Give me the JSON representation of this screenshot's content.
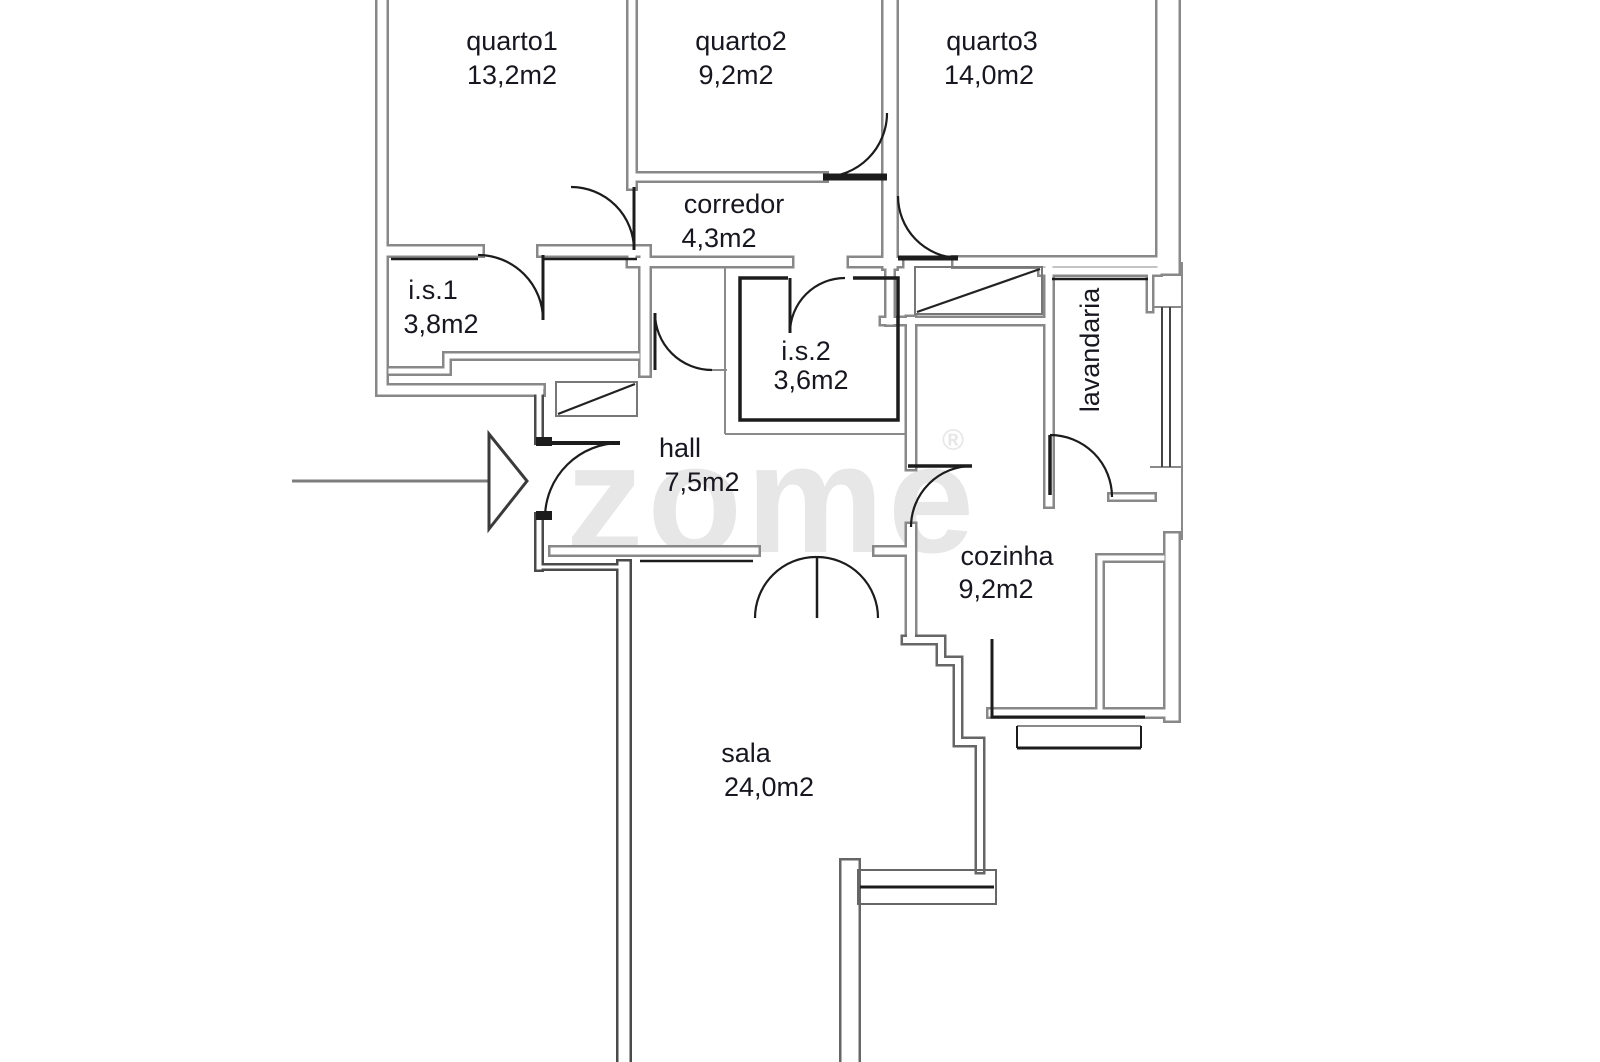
{
  "plan_title": "floor-plan",
  "watermark": {
    "text": "zome",
    "reg": "®",
    "color": "#e7e7e7"
  },
  "colors": {
    "background": "#ffffff",
    "wall_gray": "#888888",
    "wall_dark": "#4a4a4a",
    "wall_mid": "#666666",
    "thin_gray": "#8a8a8a",
    "black": "#1c1c1c",
    "label": "#17171f",
    "arrow": "#7d7d7d",
    "arrow_head": "#3a3a3a",
    "glazing": "#444444",
    "window_frame": "#666666"
  },
  "rooms": [
    {
      "id": "quarto1",
      "name": "quarto1",
      "area": "13,2m2",
      "nx": 512,
      "ny": 50,
      "ax": 512,
      "ay": 84,
      "vertical": false
    },
    {
      "id": "quarto2",
      "name": "quarto2",
      "area": "9,2m2",
      "nx": 741,
      "ny": 50,
      "ax": 736,
      "ay": 84,
      "vertical": false
    },
    {
      "id": "quarto3",
      "name": "quarto3",
      "area": "14,0m2",
      "nx": 992,
      "ny": 50,
      "ax": 989,
      "ay": 84,
      "vertical": false
    },
    {
      "id": "corredor",
      "name": "corredor",
      "area": "4,3m2",
      "nx": 734,
      "ny": 213,
      "ax": 719,
      "ay": 247,
      "vertical": false
    },
    {
      "id": "is1",
      "name": "i.s.1",
      "area": "3,8m2",
      "nx": 433,
      "ny": 299,
      "ax": 441,
      "ay": 333,
      "vertical": false
    },
    {
      "id": "is2",
      "name": "i.s.2",
      "area": "3,6m2",
      "nx": 806,
      "ny": 360,
      "ax": 811,
      "ay": 389,
      "vertical": false
    },
    {
      "id": "lavandaria",
      "name": "lavandaria",
      "area": "",
      "nx": 1099,
      "ny": 350,
      "ax": 0,
      "ay": 0,
      "vertical": true
    },
    {
      "id": "hall",
      "name": "hall",
      "area": "7,5m2",
      "nx": 680,
      "ny": 457,
      "ax": 702,
      "ay": 491,
      "vertical": false
    },
    {
      "id": "cozinha",
      "name": "cozinha",
      "area": "9,2m2",
      "nx": 1007,
      "ny": 565,
      "ax": 996,
      "ay": 598,
      "vertical": false
    },
    {
      "id": "sala",
      "name": "sala",
      "area": "24,0m2",
      "nx": 746,
      "ny": 762,
      "ax": 769,
      "ay": 796,
      "vertical": false
    }
  ],
  "entrance_arrow": {
    "line": [
      292,
      481,
      489,
      481
    ],
    "head": [
      [
        489,
        434
      ],
      [
        489,
        529
      ],
      [
        527,
        481
      ]
    ]
  },
  "geometry": {
    "walls": [
      {
        "p": [
          [
            382,
            0
          ],
          [
            382,
            390
          ],
          [
            539,
            390
          ]
        ],
        "w": 14,
        "c": "wall_gray"
      },
      {
        "p": [
          [
            539,
            394
          ],
          [
            539,
            440
          ]
        ],
        "w": 10,
        "c": "wall_dark"
      },
      {
        "p": [
          [
            539,
            517
          ],
          [
            539,
            567
          ]
        ],
        "w": 10,
        "c": "wall_dark"
      },
      {
        "p": [
          [
            539,
            567
          ],
          [
            624,
            567
          ]
        ],
        "w": 8,
        "c": "wall_dark"
      },
      {
        "p": [
          [
            624,
            567
          ],
          [
            624,
            1062
          ]
        ],
        "w": 16,
        "c": "wall_dark"
      },
      {
        "p": [
          [
            632,
            0
          ],
          [
            632,
            185
          ]
        ],
        "w": 12,
        "c": "wall_gray"
      },
      {
        "p": [
          [
            632,
            250
          ],
          [
            632,
            262
          ]
        ],
        "w": 12,
        "c": "wall_gray"
      },
      {
        "p": [
          [
            382,
            251
          ],
          [
            478,
            251
          ]
        ],
        "w": 14,
        "c": "wall_gray"
      },
      {
        "p": [
          [
            543,
            251
          ],
          [
            637,
            251
          ]
        ],
        "w": 14,
        "c": "wall_gray"
      },
      {
        "p": [
          [
            645,
            251
          ],
          [
            645,
            371
          ]
        ],
        "w": 14,
        "c": "wall_gray"
      },
      {
        "p": [
          [
            391,
            371
          ],
          [
            447,
            371
          ],
          [
            447,
            356
          ],
          [
            637,
            356
          ]
        ],
        "w": 10,
        "c": "wall_gray"
      },
      {
        "p": [
          [
            632,
            177
          ],
          [
            823,
            177
          ]
        ],
        "w": 12,
        "c": "wall_gray"
      },
      {
        "p": [
          [
            890,
            0
          ],
          [
            890,
            262
          ]
        ],
        "w": 18,
        "c": "wall_gray"
      },
      {
        "p": [
          [
            632,
            262
          ],
          [
            788,
            262
          ]
        ],
        "w": 13,
        "c": "wall_gray"
      },
      {
        "p": [
          [
            853,
            262
          ],
          [
            898,
            262
          ]
        ],
        "w": 13,
        "c": "wall_gray"
      },
      {
        "p": [
          [
            958,
            262
          ],
          [
            1162,
            262
          ]
        ],
        "w": 14,
        "c": "wall_gray"
      },
      {
        "p": [
          [
            1168,
            0
          ],
          [
            1168,
            263
          ]
        ],
        "w": 26,
        "c": "wall_gray"
      },
      {
        "p": [
          [
            890,
            262
          ],
          [
            890,
            321
          ]
        ],
        "w": 12,
        "c": "wall_gray"
      },
      {
        "p": [
          [
            884,
            321
          ],
          [
            1049,
            321
          ]
        ],
        "w": 11,
        "c": "wall_gray"
      },
      {
        "p": [
          [
            911,
            321
          ],
          [
            911,
            465
          ]
        ],
        "w": 13,
        "c": "wall_gray"
      },
      {
        "p": [
          [
            911,
            528
          ],
          [
            911,
            637
          ]
        ],
        "w": 13,
        "c": "wall_gray"
      },
      {
        "p": [
          [
            554,
            551
          ],
          [
            755,
            551
          ]
        ],
        "w": 12,
        "c": "wall_gray"
      },
      {
        "p": [
          [
            878,
            551
          ],
          [
            911,
            551
          ]
        ],
        "w": 12,
        "c": "wall_gray"
      },
      {
        "p": [
          [
            906,
            640
          ],
          [
            941,
            640
          ],
          [
            941,
            661
          ],
          [
            958,
            661
          ],
          [
            958,
            742
          ],
          [
            980,
            742
          ],
          [
            980,
            869
          ]
        ],
        "w": 11,
        "c": "wall_mid"
      },
      {
        "p": [
          [
            850,
            869
          ],
          [
            850,
            1062
          ]
        ],
        "w": 22,
        "c": "wall_mid"
      },
      {
        "p": [
          [
            1049,
            265
          ],
          [
            1049,
            503
          ]
        ],
        "w": 12,
        "c": "wall_gray"
      },
      {
        "p": [
          [
            1043,
            271
          ],
          [
            1157,
            271
          ]
        ],
        "w": 12,
        "c": "wall_gray"
      },
      {
        "p": [
          [
            1150,
            275
          ],
          [
            1150,
            309
          ]
        ],
        "w": 9,
        "c": "wall_gray"
      },
      {
        "p": [
          [
            1112,
            497
          ],
          [
            1152,
            497
          ]
        ],
        "w": 10,
        "c": "wall_gray"
      },
      {
        "p": [
          [
            1172,
            540
          ],
          [
            1172,
            714
          ]
        ],
        "w": 18,
        "c": "wall_gray"
      },
      {
        "p": [
          [
            1100,
            558
          ],
          [
            1162,
            558
          ]
        ],
        "w": 10,
        "c": "wall_gray"
      },
      {
        "p": [
          [
            1100,
            558
          ],
          [
            1100,
            714
          ]
        ],
        "w": 10,
        "c": "wall_gray"
      },
      {
        "p": [
          [
            992,
            713
          ],
          [
            1172,
            713
          ]
        ],
        "w": 12,
        "c": "wall_gray"
      }
    ],
    "thin_lines": [
      {
        "p": [
          [
            1182,
            262
          ],
          [
            1182,
            540
          ]
        ],
        "w": 2,
        "c": "thin_gray"
      },
      {
        "p": [
          [
            725,
            262
          ],
          [
            725,
            434
          ]
        ],
        "w": 2,
        "c": "thin_gray"
      },
      {
        "p": [
          [
            725,
            434
          ],
          [
            908,
            434
          ]
        ],
        "w": 2,
        "c": "thin_gray"
      },
      {
        "p": [
          [
            712,
            370
          ],
          [
            727,
            370
          ]
        ],
        "w": 2,
        "c": "thin_gray"
      },
      {
        "p": [
          [
            1150,
            307
          ],
          [
            1182,
            307
          ]
        ],
        "w": 2,
        "c": "thin_gray"
      },
      {
        "p": [
          [
            1150,
            467
          ],
          [
            1182,
            467
          ]
        ],
        "w": 2,
        "c": "thin_gray"
      },
      {
        "p": [
          [
            1017,
            726
          ],
          [
            1141,
            726
          ]
        ],
        "w": 2,
        "c": "thin_gray"
      }
    ],
    "black_lines": [
      {
        "p": [
          [
            391,
            259
          ],
          [
            478,
            259
          ]
        ],
        "w": 2.5
      },
      {
        "p": [
          [
            543,
            259
          ],
          [
            637,
            259
          ]
        ],
        "w": 2.5
      },
      {
        "p": [
          [
            640,
            561
          ],
          [
            753,
            561
          ]
        ],
        "w": 2.5
      },
      {
        "p": [
          [
            1052,
            279
          ],
          [
            1148,
            279
          ]
        ],
        "w": 2.5
      },
      {
        "p": [
          [
            992,
            639
          ],
          [
            992,
            717
          ],
          [
            1145,
            717
          ]
        ],
        "w": 3
      },
      {
        "p": [
          [
            1017,
            748
          ],
          [
            1141,
            748
          ]
        ],
        "w": 3
      },
      {
        "p": [
          [
            1017,
            726
          ],
          [
            1017,
            748
          ]
        ],
        "w": 2
      },
      {
        "p": [
          [
            1141,
            726
          ],
          [
            1141,
            748
          ]
        ],
        "w": 2
      },
      {
        "p": [
          [
            860,
            887
          ],
          [
            994,
            887
          ]
        ],
        "w": 3
      }
    ],
    "black_rects": [
      {
        "x": 536,
        "y": 437,
        "w": 16,
        "h": 9
      },
      {
        "x": 536,
        "y": 511,
        "w": 16,
        "h": 9
      }
    ],
    "is2_inner_box": "M 853,278 L 898,278 L 898,420 L 740,420 L 740,278 L 788,278",
    "doors": [
      {
        "id": "door-quarto1",
        "leaf": [
          [
            634,
            187
          ],
          [
            634,
            250
          ]
        ],
        "lw": 3,
        "arc": "M 571,187 A 63,63 0 0 1 634,250"
      },
      {
        "id": "door-quarto2",
        "leaf": [
          [
            823,
            177
          ],
          [
            887,
            177
          ]
        ],
        "lw": 7,
        "arc": "M 823,177 A 64,64 0 0 0 887,113"
      },
      {
        "id": "door-quarto3",
        "leaf": [
          [
            898,
            258
          ],
          [
            958,
            258
          ]
        ],
        "lw": 5,
        "arc": "M 898,196 A 62,62 0 0 0 958,258"
      },
      {
        "id": "door-is1",
        "leaf": [
          [
            543,
            255
          ],
          [
            543,
            320
          ]
        ],
        "lw": 3,
        "arc": "M 478,255 A 65,65 0 0 1 543,320"
      },
      {
        "id": "door-is2",
        "leaf": [
          [
            790,
            278
          ],
          [
            790,
            333
          ]
        ],
        "lw": 3,
        "arc": "M 790,333 A 55,55 0 0 1 845,278"
      },
      {
        "id": "door-corredor",
        "leaf": [
          [
            655,
            313
          ],
          [
            655,
            370
          ]
        ],
        "lw": 3,
        "arc": "M 655,313 A 57,57 0 0 0 712,370"
      },
      {
        "id": "door-entrada",
        "leaf": [
          [
            545,
            443
          ],
          [
            620,
            443
          ]
        ],
        "lw": 4,
        "arc": "M 620,443 A 75,75 0 0 0 545,517"
      },
      {
        "id": "door-cozinha",
        "leaf": [
          [
            908,
            466
          ],
          [
            972,
            466
          ]
        ],
        "lw": 3.5,
        "arc": "M 972,466 A 61,61 0 0 0 911,527"
      },
      {
        "id": "door-lavandaria",
        "leaf": [
          [
            1050,
            435
          ],
          [
            1050,
            495
          ]
        ],
        "lw": 3.5,
        "arc": "M 1050,435 A 62,62 0 0 1 1112,497"
      },
      {
        "id": "door-sala-left",
        "leaf": [
          [
            817,
            556
          ],
          [
            817,
            618
          ]
        ],
        "lw": 2.5,
        "arc": "M 816,557 A 61,61 0 0 0 755,618"
      },
      {
        "id": "door-sala-right",
        "leaf": null,
        "lw": 0,
        "arc": "M 817,557 A 61,61 0 0 1 878,618"
      }
    ],
    "windows": [
      {
        "id": "window-lavandaria",
        "lines": [
          [
            [
              1162,
              307
            ],
            [
              1162,
              467
            ]
          ],
          [
            [
              1170,
              307
            ],
            [
              1170,
              467
            ]
          ]
        ],
        "w": 2
      },
      {
        "id": "window-sala-sul",
        "rect": {
          "x": 858,
          "y": 870,
          "w": 138,
          "h": 34
        }
      }
    ],
    "closets": [
      {
        "id": "closet-hall",
        "rect": {
          "x": 556,
          "y": 382,
          "w": 81,
          "h": 34
        },
        "diag": [
          [
            558,
            414
          ],
          [
            635,
            384
          ]
        ]
      },
      {
        "id": "closet-corredor",
        "rect": {
          "x": 915,
          "y": 267,
          "w": 127,
          "h": 47
        },
        "diag": [
          [
            917,
            312
          ],
          [
            1040,
            269
          ]
        ]
      }
    ]
  }
}
